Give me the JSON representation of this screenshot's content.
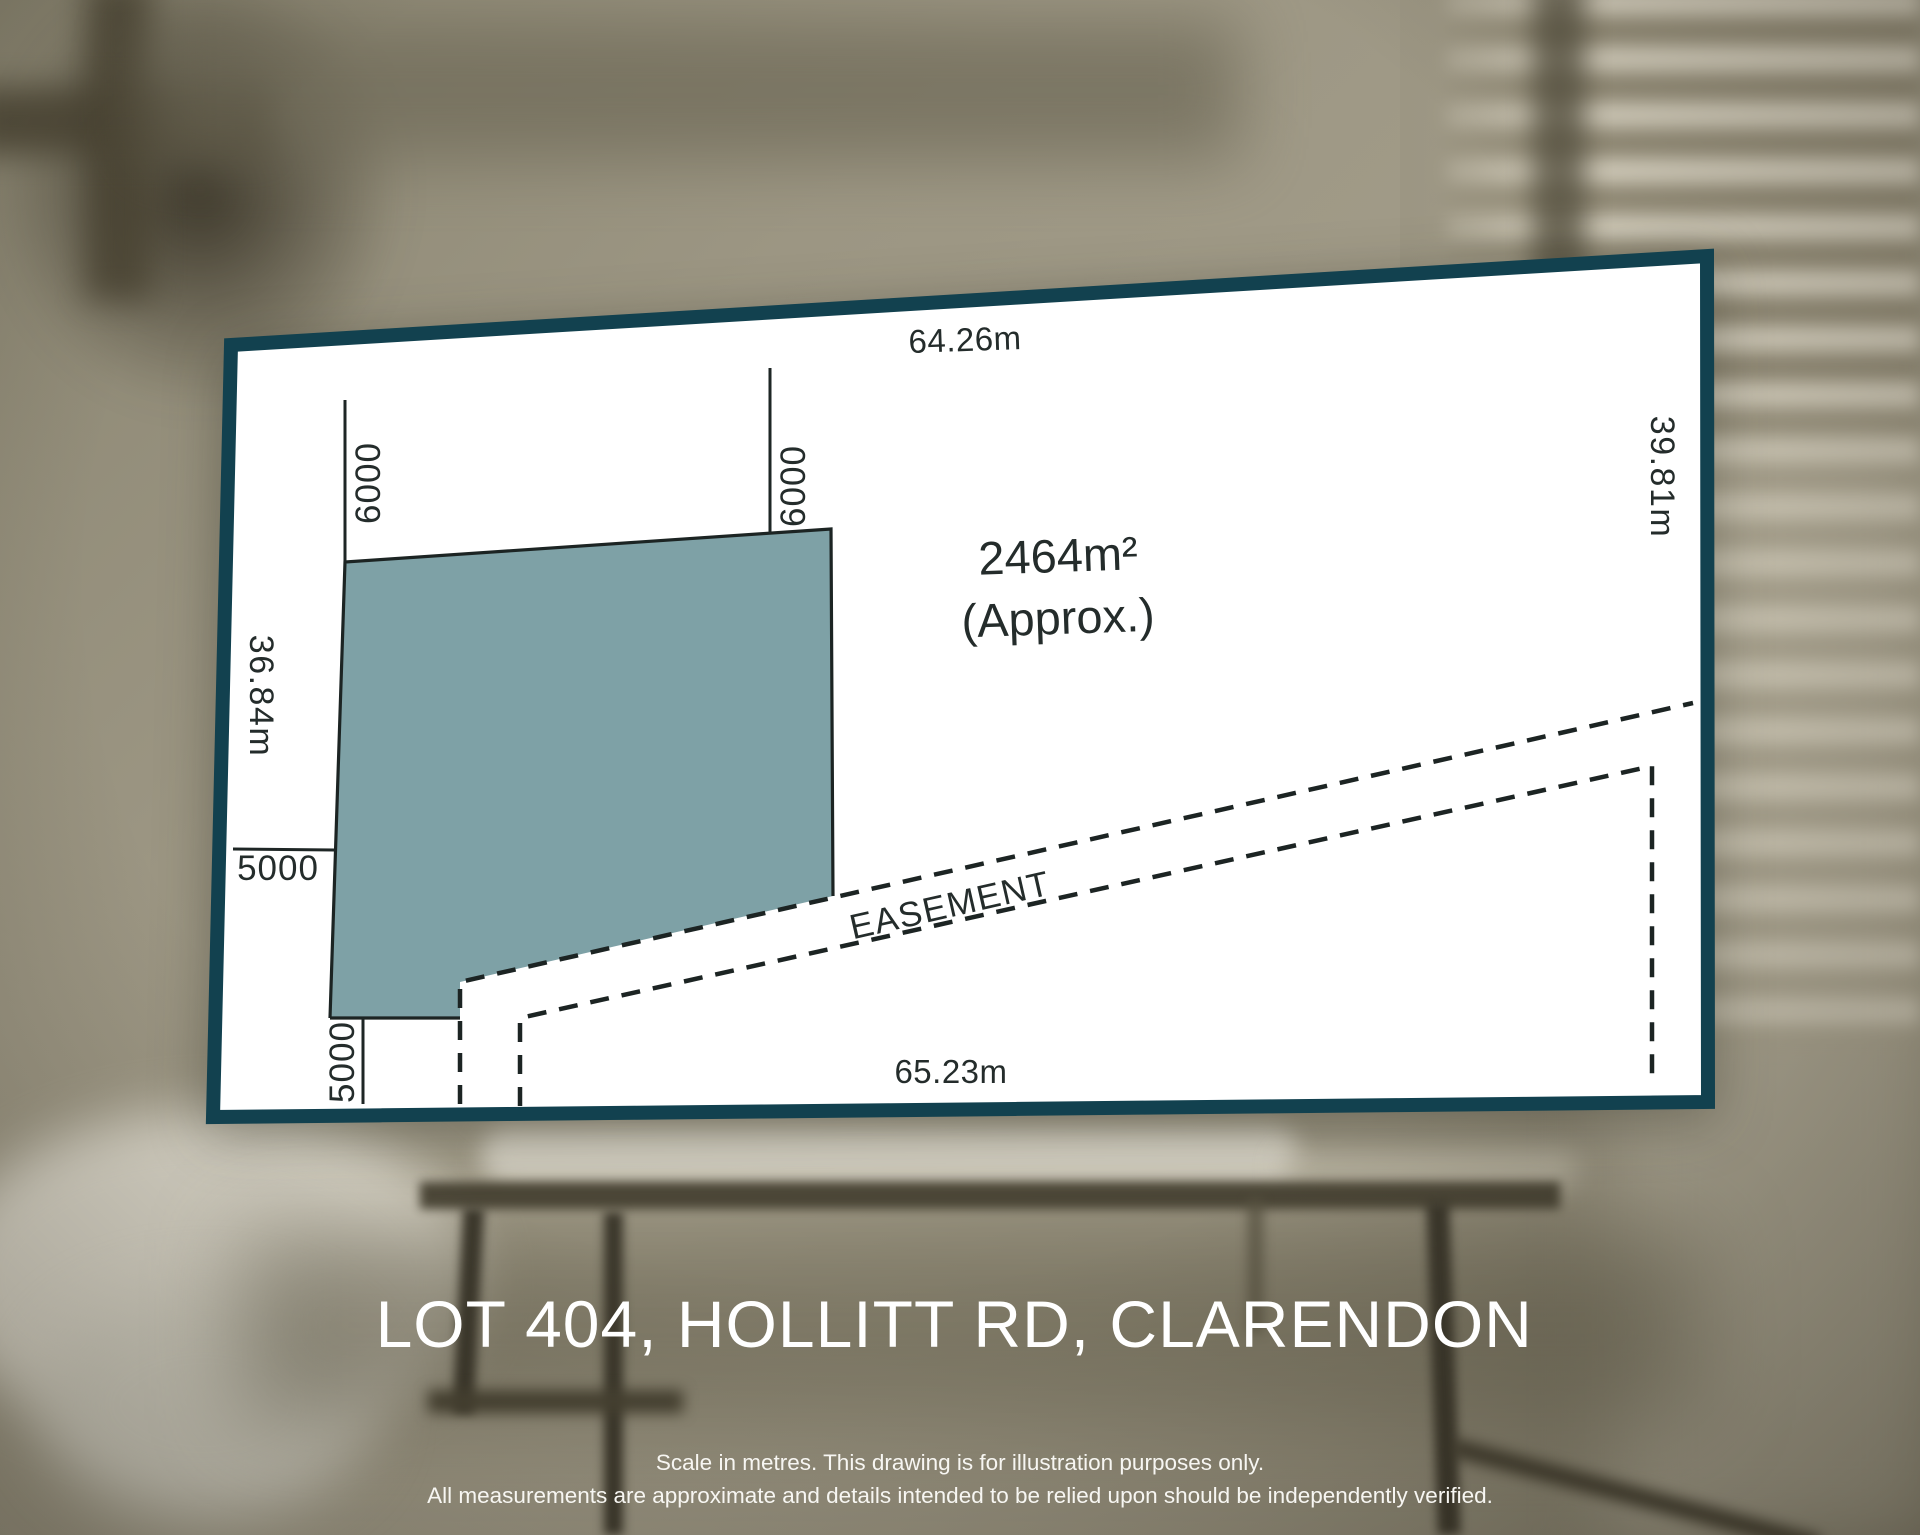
{
  "title": "LOT 404, HOLLITT RD, CLARENDON",
  "disclaimer": {
    "line1": "Scale in metres. This drawing is for illustration purposes only.",
    "line2": "All measurements are approximate and details intended to be relied upon should be independently verified."
  },
  "diagram": {
    "area": "2464m²",
    "area_qualifier": "(Approx.)",
    "easement_label": "EASEMENT",
    "dimensions": {
      "top_boundary": "64.26m",
      "bottom_boundary": "65.23m",
      "left_boundary": "36.84m",
      "right_boundary": "39.81m",
      "left_setback": "5000",
      "bottom_setback": "5000",
      "envelope_left": "6000",
      "envelope_right": "6000"
    }
  },
  "colors": {
    "panel_border": "#12414f",
    "lot_fill": "#7ea1a6",
    "ink": "#242c2b",
    "title_text": "#ffffff"
  }
}
